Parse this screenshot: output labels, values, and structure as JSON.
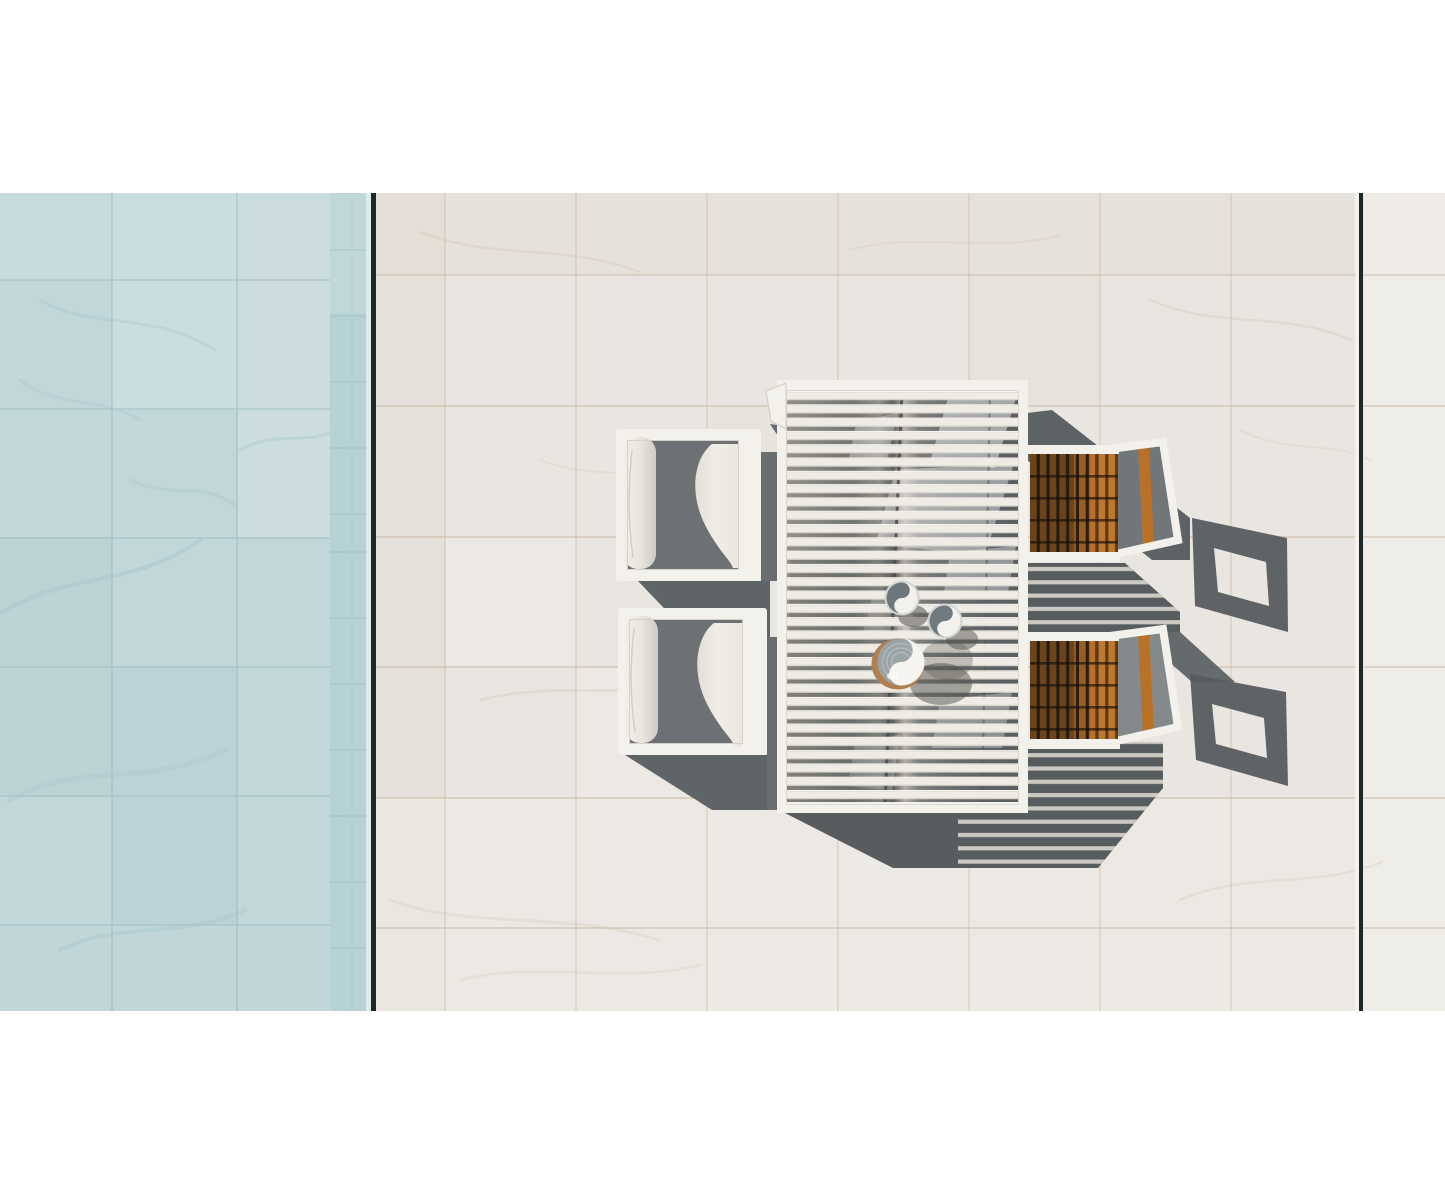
{
  "meta": {
    "domain": "Natural-Image",
    "description": "Aerial top-down photograph of a white outdoor dining set on a white marble terrace beside a pale-blue marble swimming pool; harsh sunlight from the upper left casts long grey shadows toward the lower right.",
    "image_width_px": 1445,
    "image_height_px": 1204,
    "photo_area": {
      "top_px": 193,
      "bottom_px": 1011,
      "letterbox": "white bars above and below"
    }
  },
  "scene": {
    "pool": {
      "label": "swimming pool with pale blue-grey marble tiles",
      "position": "left edge of frame"
    },
    "pool_edge": {
      "label": "narrow glass infinity-edge band with dark seam line",
      "position": "between pool and terrace"
    },
    "terrace": {
      "label": "white marble tiled terrace",
      "tile_grid": "large square tiles, thin tan joint lines",
      "expansion_joint": "dark vertical seam near right edge"
    },
    "dining_table": {
      "label": "white aluminium slatted rectangular dining table, seen from directly above",
      "slats": "horizontal, with centre seam",
      "position": "centre-right"
    },
    "armchairs": {
      "count": 2,
      "label": "white cube lounge armchairs with white bolster and seat cushions",
      "position": "left side of table, facing right"
    },
    "teak_chairs": {
      "count": 2,
      "label": "white-framed dining chairs with teak slat seats and open white back frames",
      "position": "right side of table"
    },
    "tableware": {
      "small_bowls": 2,
      "large_bowl": 1,
      "large_bowl_detail": "grey and white bowl on round wooden charger"
    },
    "lighting": {
      "sun": "upper left",
      "shadow_direction": "lower right",
      "shadow_style": "hard-edged, slat-striped where light passes through table top"
    }
  },
  "palette": {
    "letterbox": "#ffffff",
    "pool": "#c2d7d9",
    "pool_light": "#d3e4e4",
    "pool_dark": "#b3cfd2",
    "pool_joint": "#9cbec2",
    "band": "#b7d2d5",
    "edge_dark": "#1b2a27",
    "deck": "#e9e5e0",
    "deck_warm": "#e2dbd2",
    "deck_light": "#f0ede9",
    "deck_joint": "#c9b9a3",
    "white_furniture": "#f3f1eb",
    "frame_edge": "#d6d2ca",
    "slat": "#efece6",
    "under_shadow": "#575c5f",
    "soft_shadow": "#5f6467",
    "gap_shadow": "#6a6e71",
    "seat_shadow": "#6d7174",
    "cushion": "#edeae3",
    "bolster": "#e9e6df",
    "stripe": "#d8d5ce",
    "teak": "#b97128",
    "teak_dark": "#2e2115",
    "teak_bright": "#d68e3c",
    "bowl_grey": "#6e787c",
    "bowl_body": "#9aa3a6",
    "bowl_white": "#f2f1ed",
    "charger": "#b08150"
  }
}
